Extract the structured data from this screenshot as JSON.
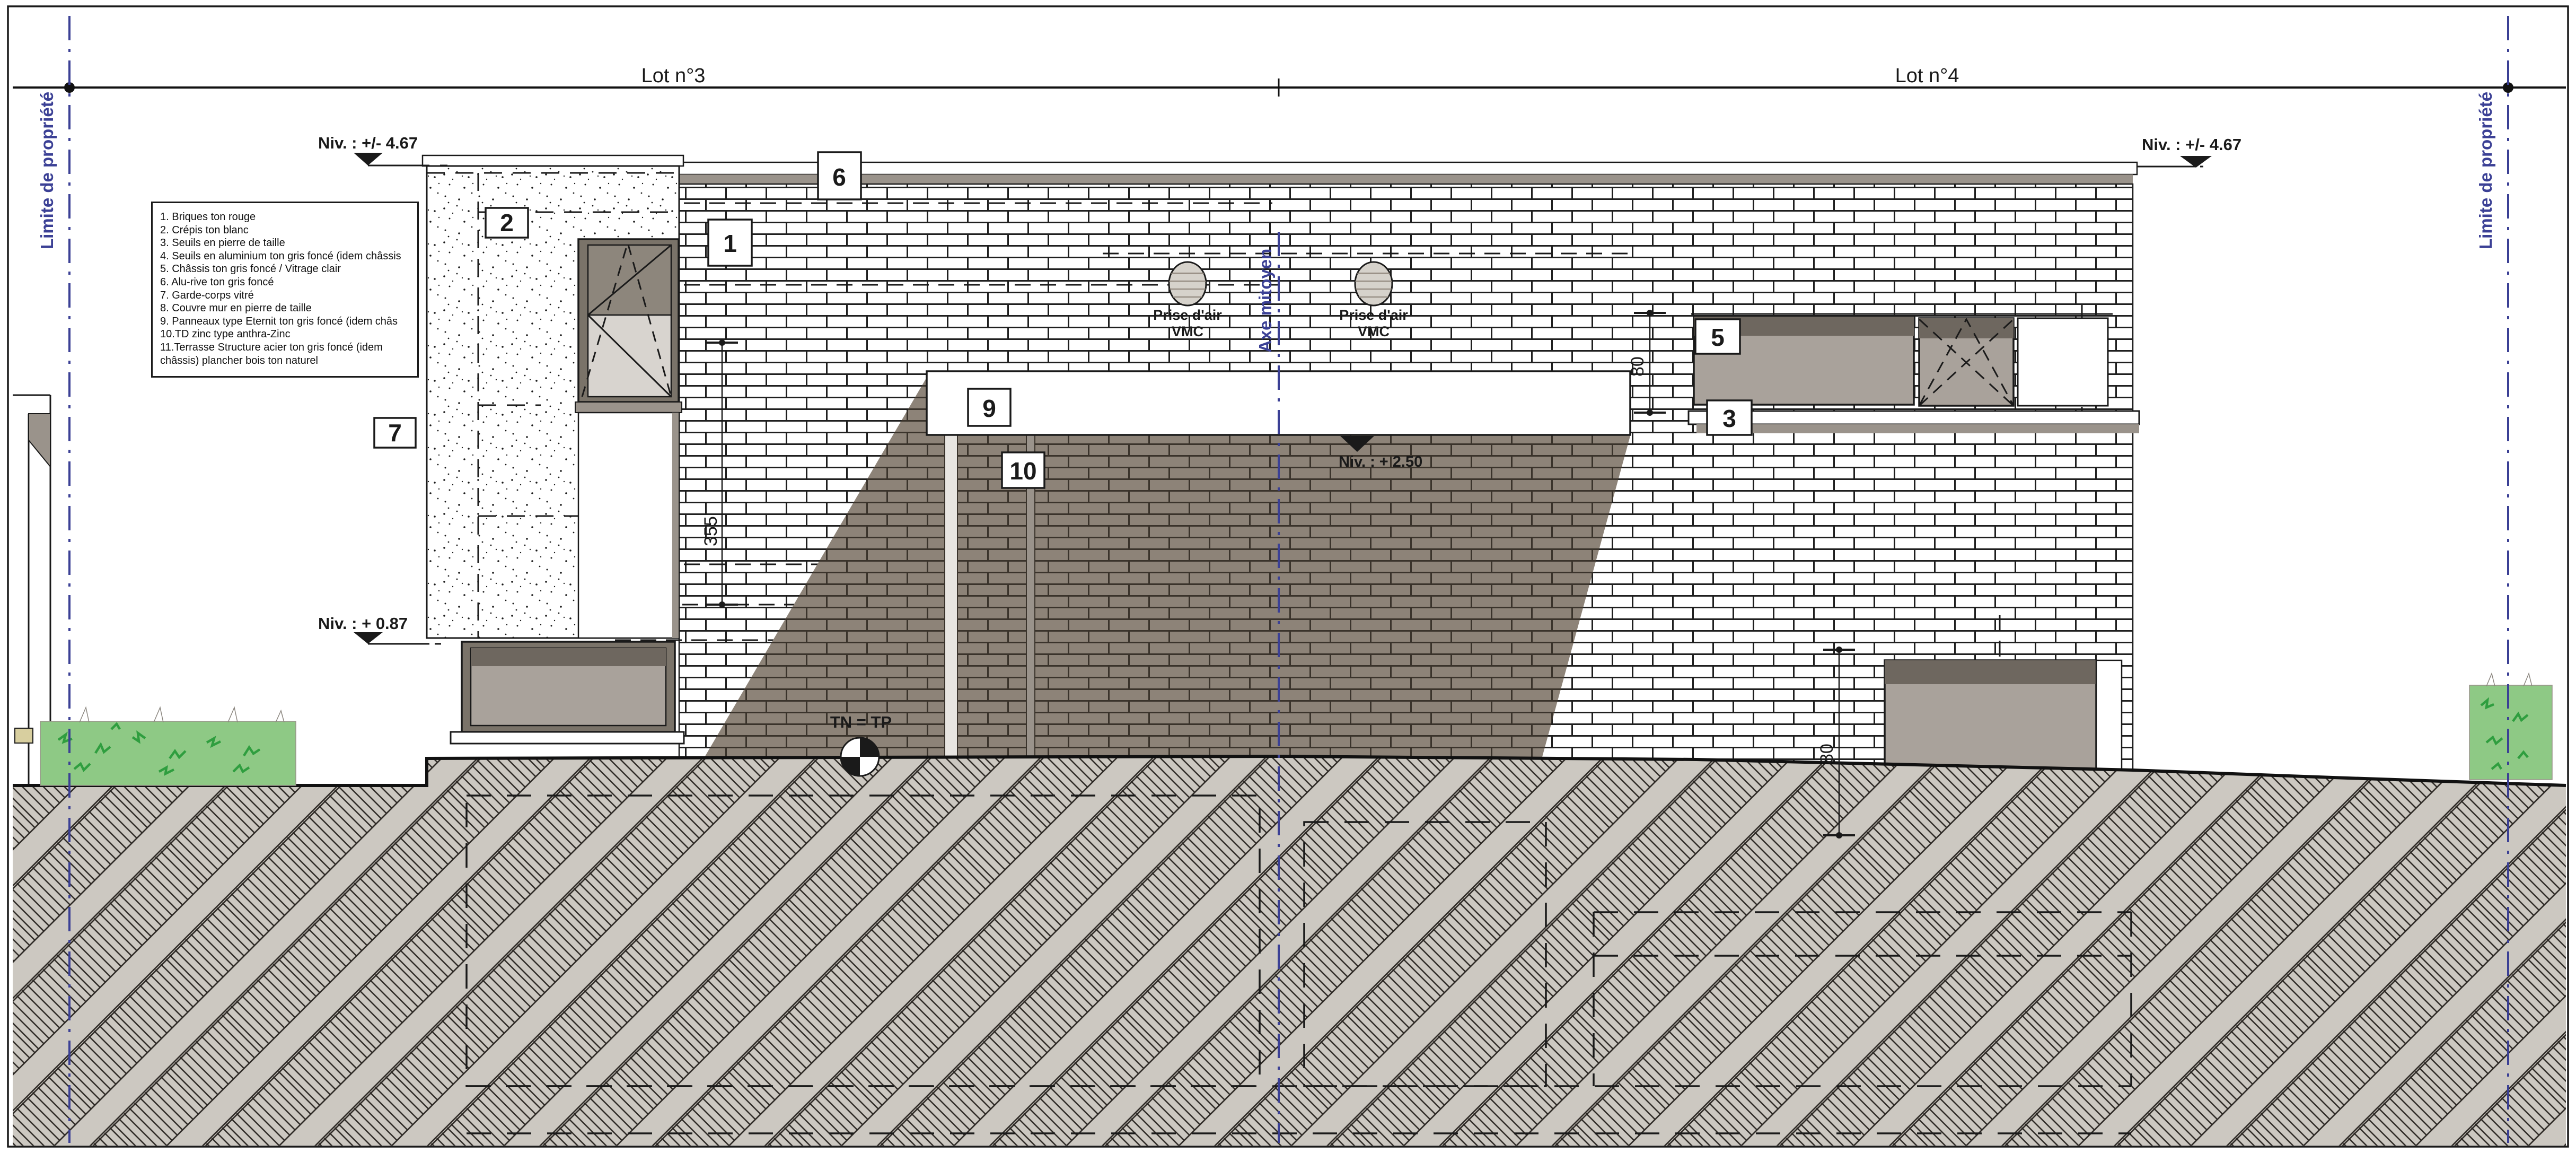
{
  "lots": {
    "left": "Lot n°3",
    "right": "Lot n°4"
  },
  "property_limits": {
    "left": "Limite de propriété",
    "right": "Limite de propriété"
  },
  "axis": {
    "label": "Axe mitoyen"
  },
  "levels": {
    "roof_left": "Niv. : +/- 4.67",
    "roof_right": "Niv. : +/- 4.67",
    "mid_left": "Niv. : + 0.87",
    "canopy": "Niv. : + 2.50"
  },
  "ground": {
    "label": "TN = TP"
  },
  "vents": {
    "line1": "Prise d'air",
    "line2": "VMC"
  },
  "dimensions": {
    "wall": "355",
    "upper_right": "80",
    "lower_right": "80"
  },
  "callouts": {
    "c1": "1",
    "c2": "2",
    "c3": "3",
    "c5": "5",
    "c6": "6",
    "c7": "7",
    "c9": "9",
    "c10": "10"
  },
  "legend": {
    "items": [
      "1. Briques ton rouge",
      "2. Crépis ton blanc",
      "3. Seuils en pierre de taille",
      "4. Seuils en aluminium ton gris foncé (idem châssis",
      "5. Châssis ton gris foncé / Vitrage clair",
      "6. Alu-rive ton gris foncé",
      "7. Garde-corps vitré",
      "8. Couvre mur en pierre de taille",
      "9. Panneaux type Eternit ton gris foncé (idem châs",
      "10.TD zinc type anthra-Zinc",
      "11.Terrasse Structure acier ton gris foncé (idem châssis) plancher bois ton naturel"
    ]
  },
  "palette": {
    "paper": "#ffffff",
    "line": "#1a1a1a",
    "blue": "#3b4095",
    "shadow_brick": "#8d8378",
    "glass": "#a9a29b",
    "glass_dark": "#8d867c",
    "glass_light": "#d8d4cf",
    "frame_dark": "#6e675f",
    "grey_trim": "#9a938b",
    "ground_fill": "#ccc8c1",
    "bush_fill": "#8ec985",
    "bush_stroke": "#2f9e3f"
  }
}
